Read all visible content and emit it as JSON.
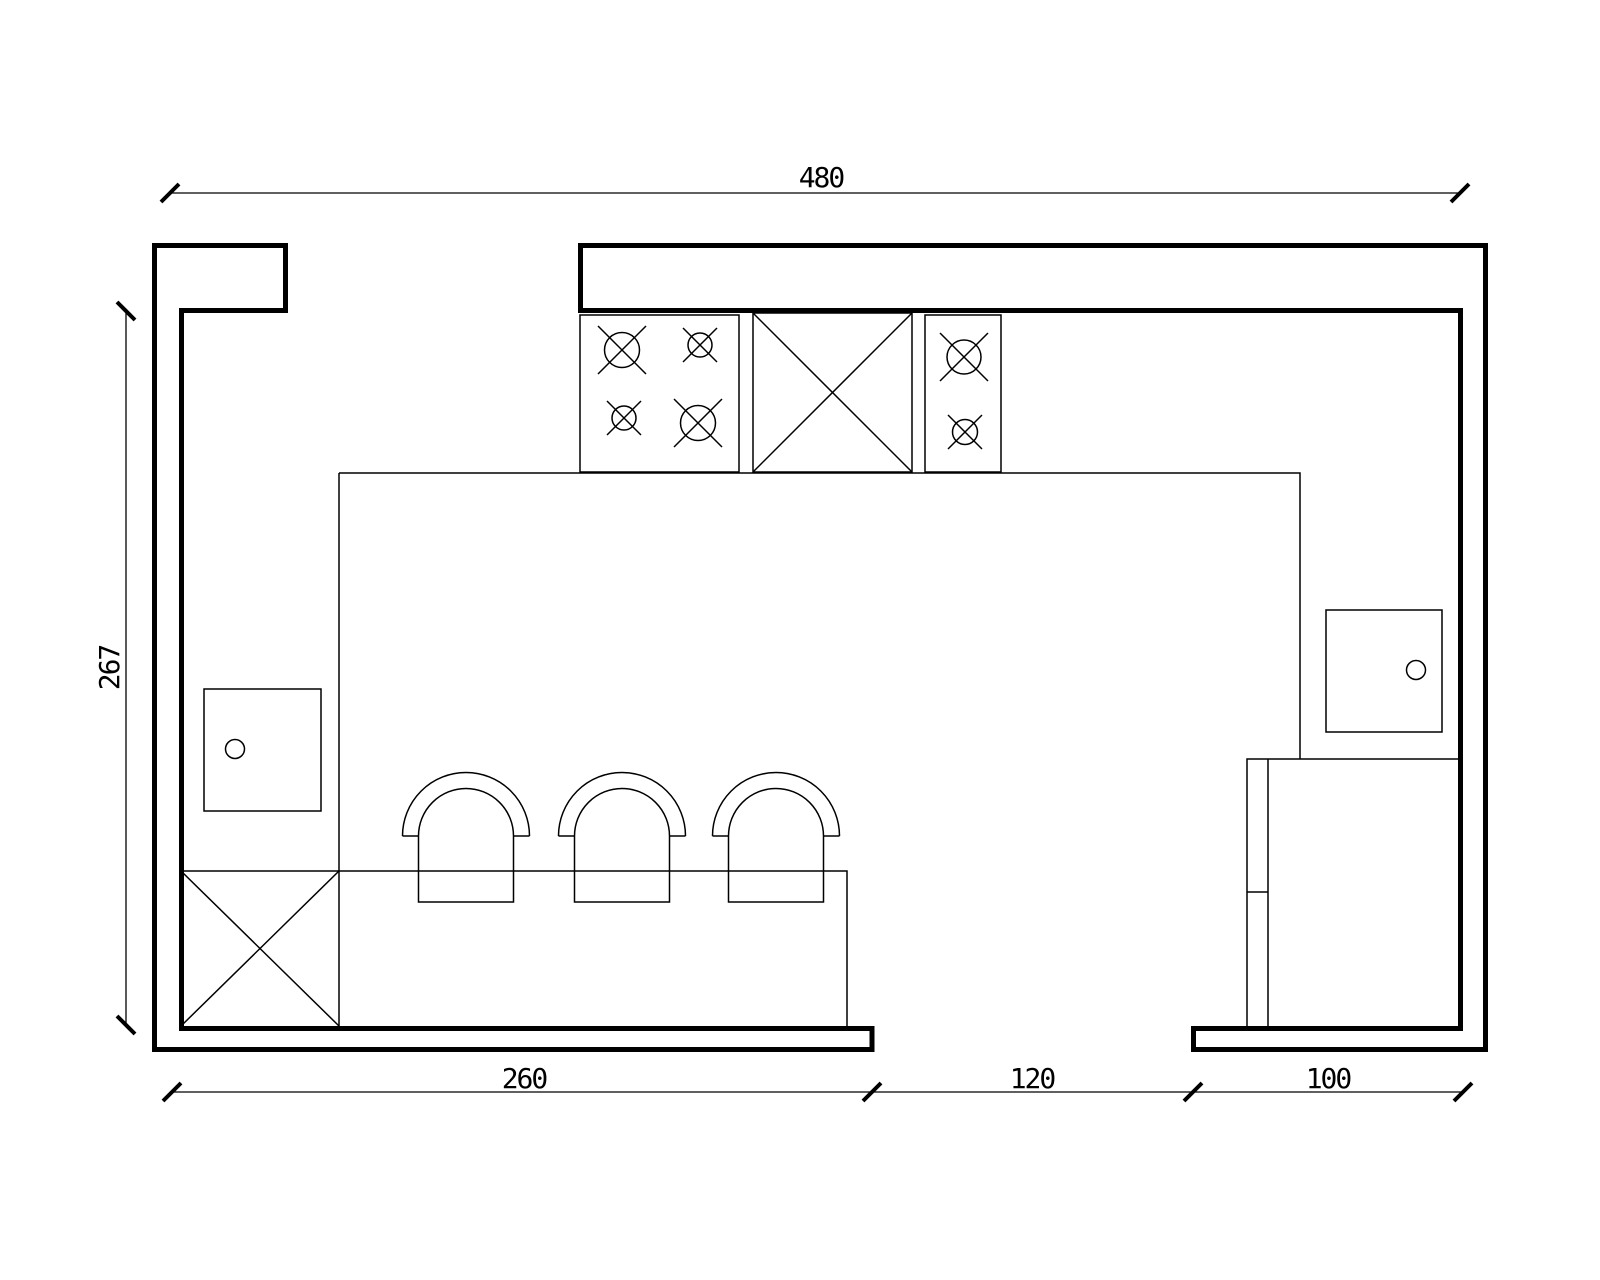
{
  "drawing_type": "kitchen-floor-plan",
  "colors": {
    "line": "#000000",
    "background": "#ffffff"
  },
  "dimensions": {
    "top": {
      "label": "480"
    },
    "left": {
      "label": "267"
    },
    "bottom": [
      {
        "label": "260"
      },
      {
        "label": "120"
      },
      {
        "label": "100"
      }
    ]
  },
  "fixtures": [
    "four-burner-cooktop",
    "two-burner-cooktop",
    "crossed-cabinet-top",
    "crossed-cabinet-island",
    "sink-left",
    "sink-right",
    "bar-stool-1",
    "bar-stool-2",
    "bar-stool-3",
    "fridge-cabinet"
  ]
}
